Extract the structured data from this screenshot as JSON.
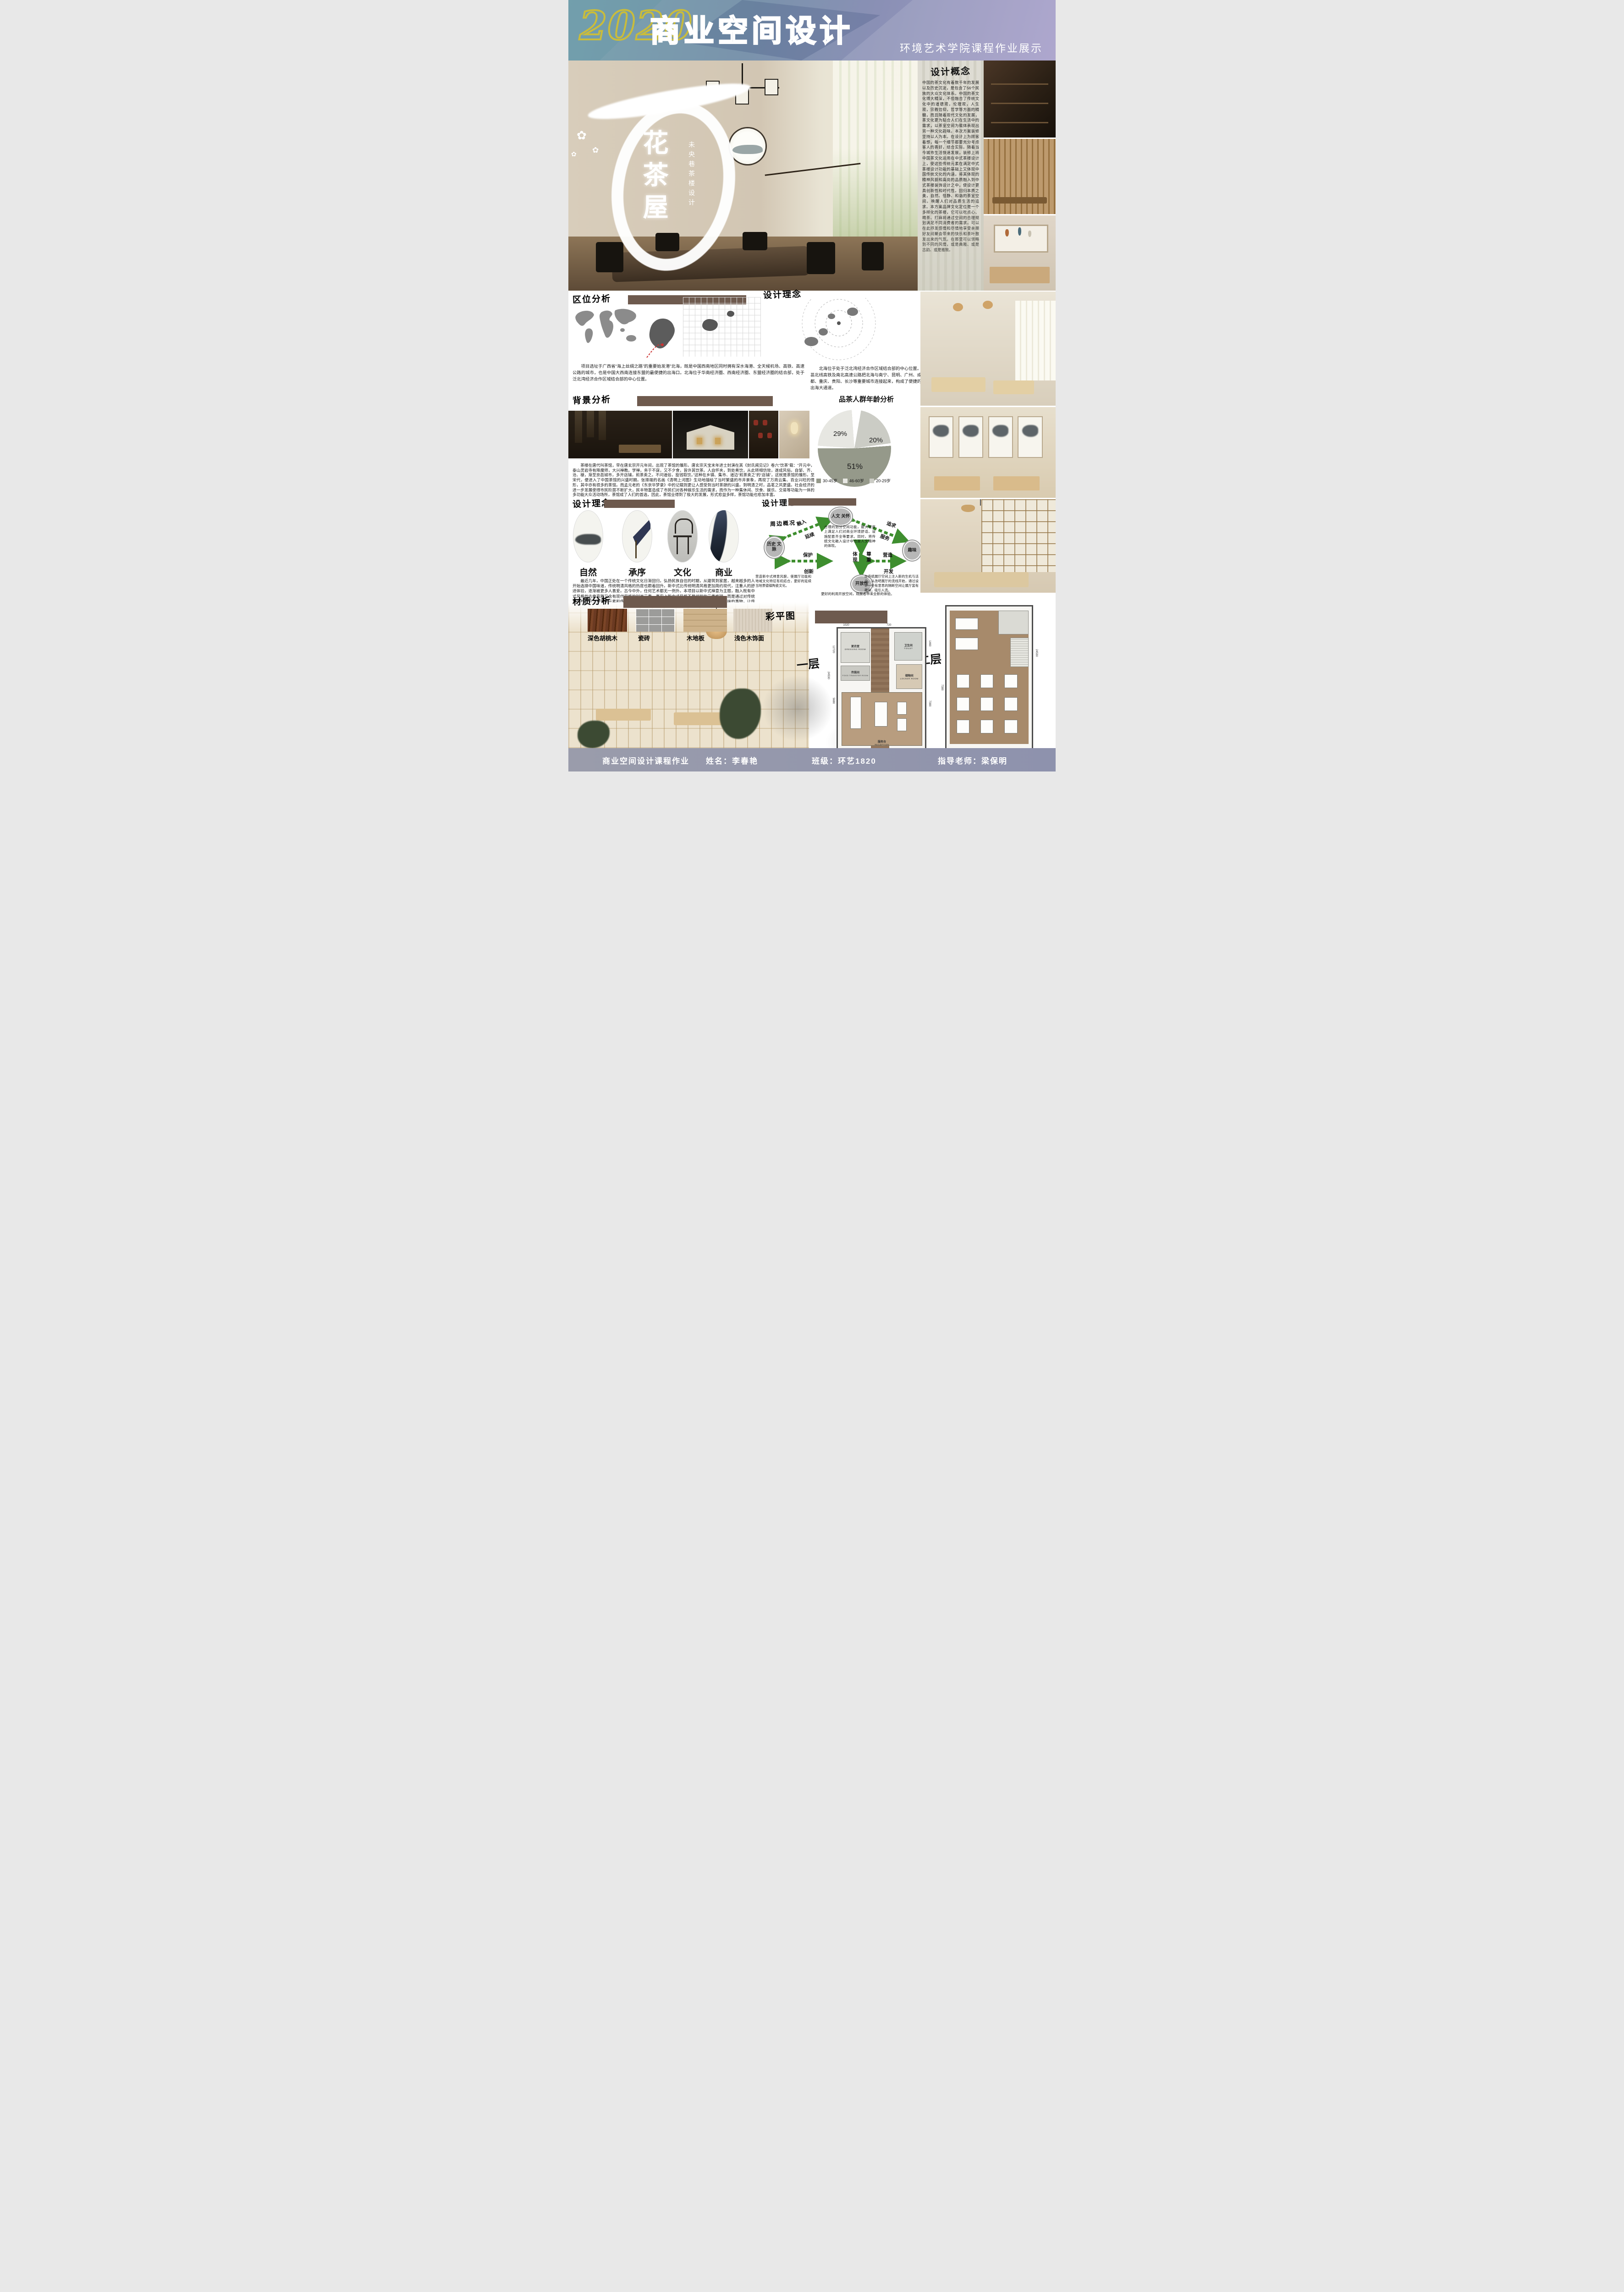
{
  "header": {
    "year": "2020",
    "title": "商业空间设计",
    "subtitle": "环境艺术学院课程作业展示"
  },
  "hero": {
    "title_vertical": "花茶屋",
    "subtitle_vertical": "未央巷茶楼设计"
  },
  "concept": {
    "heading": "设计概念",
    "body": "中国的茶文化有着数千年的发展以及历史沉淀，是包含了56个民族的大众文化体系。中国的茶文化博大精深，不但融合了传统文化中的道德观，伦理观，人生观，宗教信仰，哲学等方面的精髓，而且随着现代文化的发展，茶文化更为贴合人们在生活中的需求，以茶室空间为载体表现出另一种文化韵味。本次方案装修坚持以人为本。在设计上为顾客着想，每一个细节都要充分考虑客人的喜好，结合实际。随着当今城市生活快速发展，装修上将中国茶文化运用在中式茶楼设计上，使这些传统元素在满足中式茶楼设计功能的基础上又体现中国传统文化的内涵，将其体现的精神风貌和高尚的品质融入到中式茶楼装饰设计之中，使设计更具创新性和时代性。回归本质之美，自然、恬静、和谐的茶室空间。唤醒人们对品质生活的追求。本方案品牌文化定位是一个多样化的茶楼，它可以吃点心、喝茶、打麻将通过空间的合理规划满足不同消费者的需求。可以在此抒发感情和尽情地享受亲朋好友间聚会带来的快乐和茶叶散发出来的气氛。在那里可以领略到不同的风情，或是典雅、或是古韵、或是雅致。"
  },
  "location": {
    "heading": "区位分析",
    "para_left": "项目选址于广西省“海上丝绸之路”的重要始发港”北海，既是中国西南地区同时拥有深水海港、全天候机场、高铁、高速公路的城市，也是中国大西南连接东盟的最便捷的出海口。北海位于华南经济圈、西南经济圈、东盟经济圈的结合部，处于泛北湾经济合作区域结合部的中心位置。",
    "para_right": "北海位于处于泛北湾经济合作区域结合部的中心位置。邕北线高铁及南北高速公路把北海与南宁、昆明、广州、成都、重庆、贵阳、长沙等重要城市连接起来，构成了便捷的出海大通道。"
  },
  "design_idea": {
    "heading": "设计理念"
  },
  "background": {
    "heading": "背景分析",
    "para": "茶楼在唐代叫茶馆，早在唐玄宗开元年间，出现了茶馆的雏形。唐玄宗天宝末年进士封演在其《封氏闻见记》卷六“饮茶”载：“开元中，泰山灵岩寺有降魔师，大兴禅教。学禅，务于不寐，又不夕食，皆许其饮茶。人自怀夹，到处煮饮，从此转相仿效，遂成风俗。自邹、齐、沧、棣，渐至京邑城市，多开店铺，煎茶卖之。不问道俗，投钱取饮。”这种在乡镇、集市、道边“煎茶卖之”的“店铺”，这就是茶馆的雏形。至宋代，便进入了中国茶馆的兴盛时期。张择端的名画《清明上河图》生动地描绘了当时繁盛的市井景象，再现了万商云集、百业兴旺的情形，其中亦有很多的茶馆。而孟元老的《东京华梦录》中的记载则更让人感受到当时茶肆的兴盛。到明清之时，品茗之风更盛。社会经济的进一步发展使得市民阶层不断扩大，民丰物富造成了市民们对各种娱乐生活的需求，而作为一种集休闲、饮食、娱乐、交易等功能为一体的多功能大众活动场所，茶馆成了人们的首选，因此，茶馆业得到了极大的发展，形式愈益多样，茶馆功能也愈加丰富。"
  },
  "concept_circles": {
    "heading": "设计理念",
    "items": [
      {
        "label": "自然"
      },
      {
        "label": "承序"
      },
      {
        "label": "文化"
      },
      {
        "label": "商业"
      }
    ],
    "para": "最近几年，中国正处在一个传统文化日渐回归，弘扬民族自信的时期，从建筑到家居，越来越多的人开始选择中国味道，传统明清风格的热度也跟着回升。新中式比传统明清风格更加简约现代，注重人的舒适体验，逐渐被更多人喜爱。古今中外，任何艺术都无一例外。本项目以新中式禅意为主题，融入既有中式风格的古典高雅又含有现代风格的时尚元素，事实上新中式风格不是纯粹的元素堆砌，而是通过对传统文化的认识，将现代元素和传统元素结合在一起，以现代人的审美需求来打造富有传统韵味的事物，让传统艺术在当今社会得到合适的体现。"
  },
  "diagram": {
    "heading": "设计理念",
    "side_label": "周边概况",
    "nodes": {
      "top": "人文 关怀",
      "left": "历史 文脉",
      "right": "趣味",
      "bottom": "开放性"
    },
    "arrows": {
      "left_diag_a": "融入",
      "left_diag_b": "延续",
      "right_diag_a": "追求",
      "right_diag_b": "服务",
      "h_left_a": "保护",
      "h_left_b": "创新",
      "h_right_a": "营造",
      "h_right_b": "开发",
      "v_a": "体现",
      "v_b": "尊重"
    },
    "center_text": "合理的划分空间功能，最大程度上满足人们对商业环境舒适、设施配套齐全等要求。同时，将传统文化融入设计中也是人文精神的体现。",
    "left_note": "营造新中式禅意风貌，使展厅功能和地域文化特征有机结合，更好的延续当地景德镇陶瓷文化。",
    "right_note": "在传统展厅空间上注入新的生机与活力，从改吧展厅的流线开始，通过设计一些有意思的隔断空间让展厅富有趣味，吸引人流。",
    "bottom_note": "更好的利用开放空间，观展者带来全新的体验。"
  },
  "materials": {
    "heading": "材质分析",
    "items": [
      {
        "label": "深色胡桃木"
      },
      {
        "label": "瓷砖"
      },
      {
        "label": "木地板"
      },
      {
        "label": "浅色木饰面"
      }
    ]
  },
  "plan": {
    "heading": "彩平图",
    "floor1_label": "一层",
    "floor2_label": "二层",
    "floor1": {
      "rooms": [
        {
          "cn": "更衣室",
          "en": "DRESSING ROOM"
        },
        {
          "cn": "卫生间",
          "en": "TOILET"
        },
        {
          "cn": "传菜间",
          "en": "FOOD TRANSFER ROOM"
        },
        {
          "cn": "储物间",
          "en": "LOCKER ROOM"
        },
        {
          "cn": "服务台",
          "en": "RECEPTION"
        }
      ],
      "dims": [
        "24530",
        "12720",
        "5680",
        "1020",
        "930",
        "720",
        "2840",
        "1460",
        "7390",
        "280"
      ]
    },
    "floor2": {
      "dims": [
        "24530",
        "7390"
      ]
    }
  },
  "footer": {
    "course": "商业空间设计课程作业",
    "name": "姓名：李春艳",
    "class": "班级：环艺1820",
    "teacher": "指导老师：梁保明"
  },
  "chart_data": {
    "type": "pie",
    "title": "品茶人群年龄分析",
    "labels": [
      "30-45岁",
      "46-60岁",
      "20-29岁"
    ],
    "values": [
      51,
      29,
      20
    ],
    "value_labels": [
      "51%",
      "29%",
      "20%"
    ],
    "colors": [
      "#95998a",
      "#e7e7e2",
      "#cbccc5"
    ],
    "legend_position": "bottom"
  }
}
